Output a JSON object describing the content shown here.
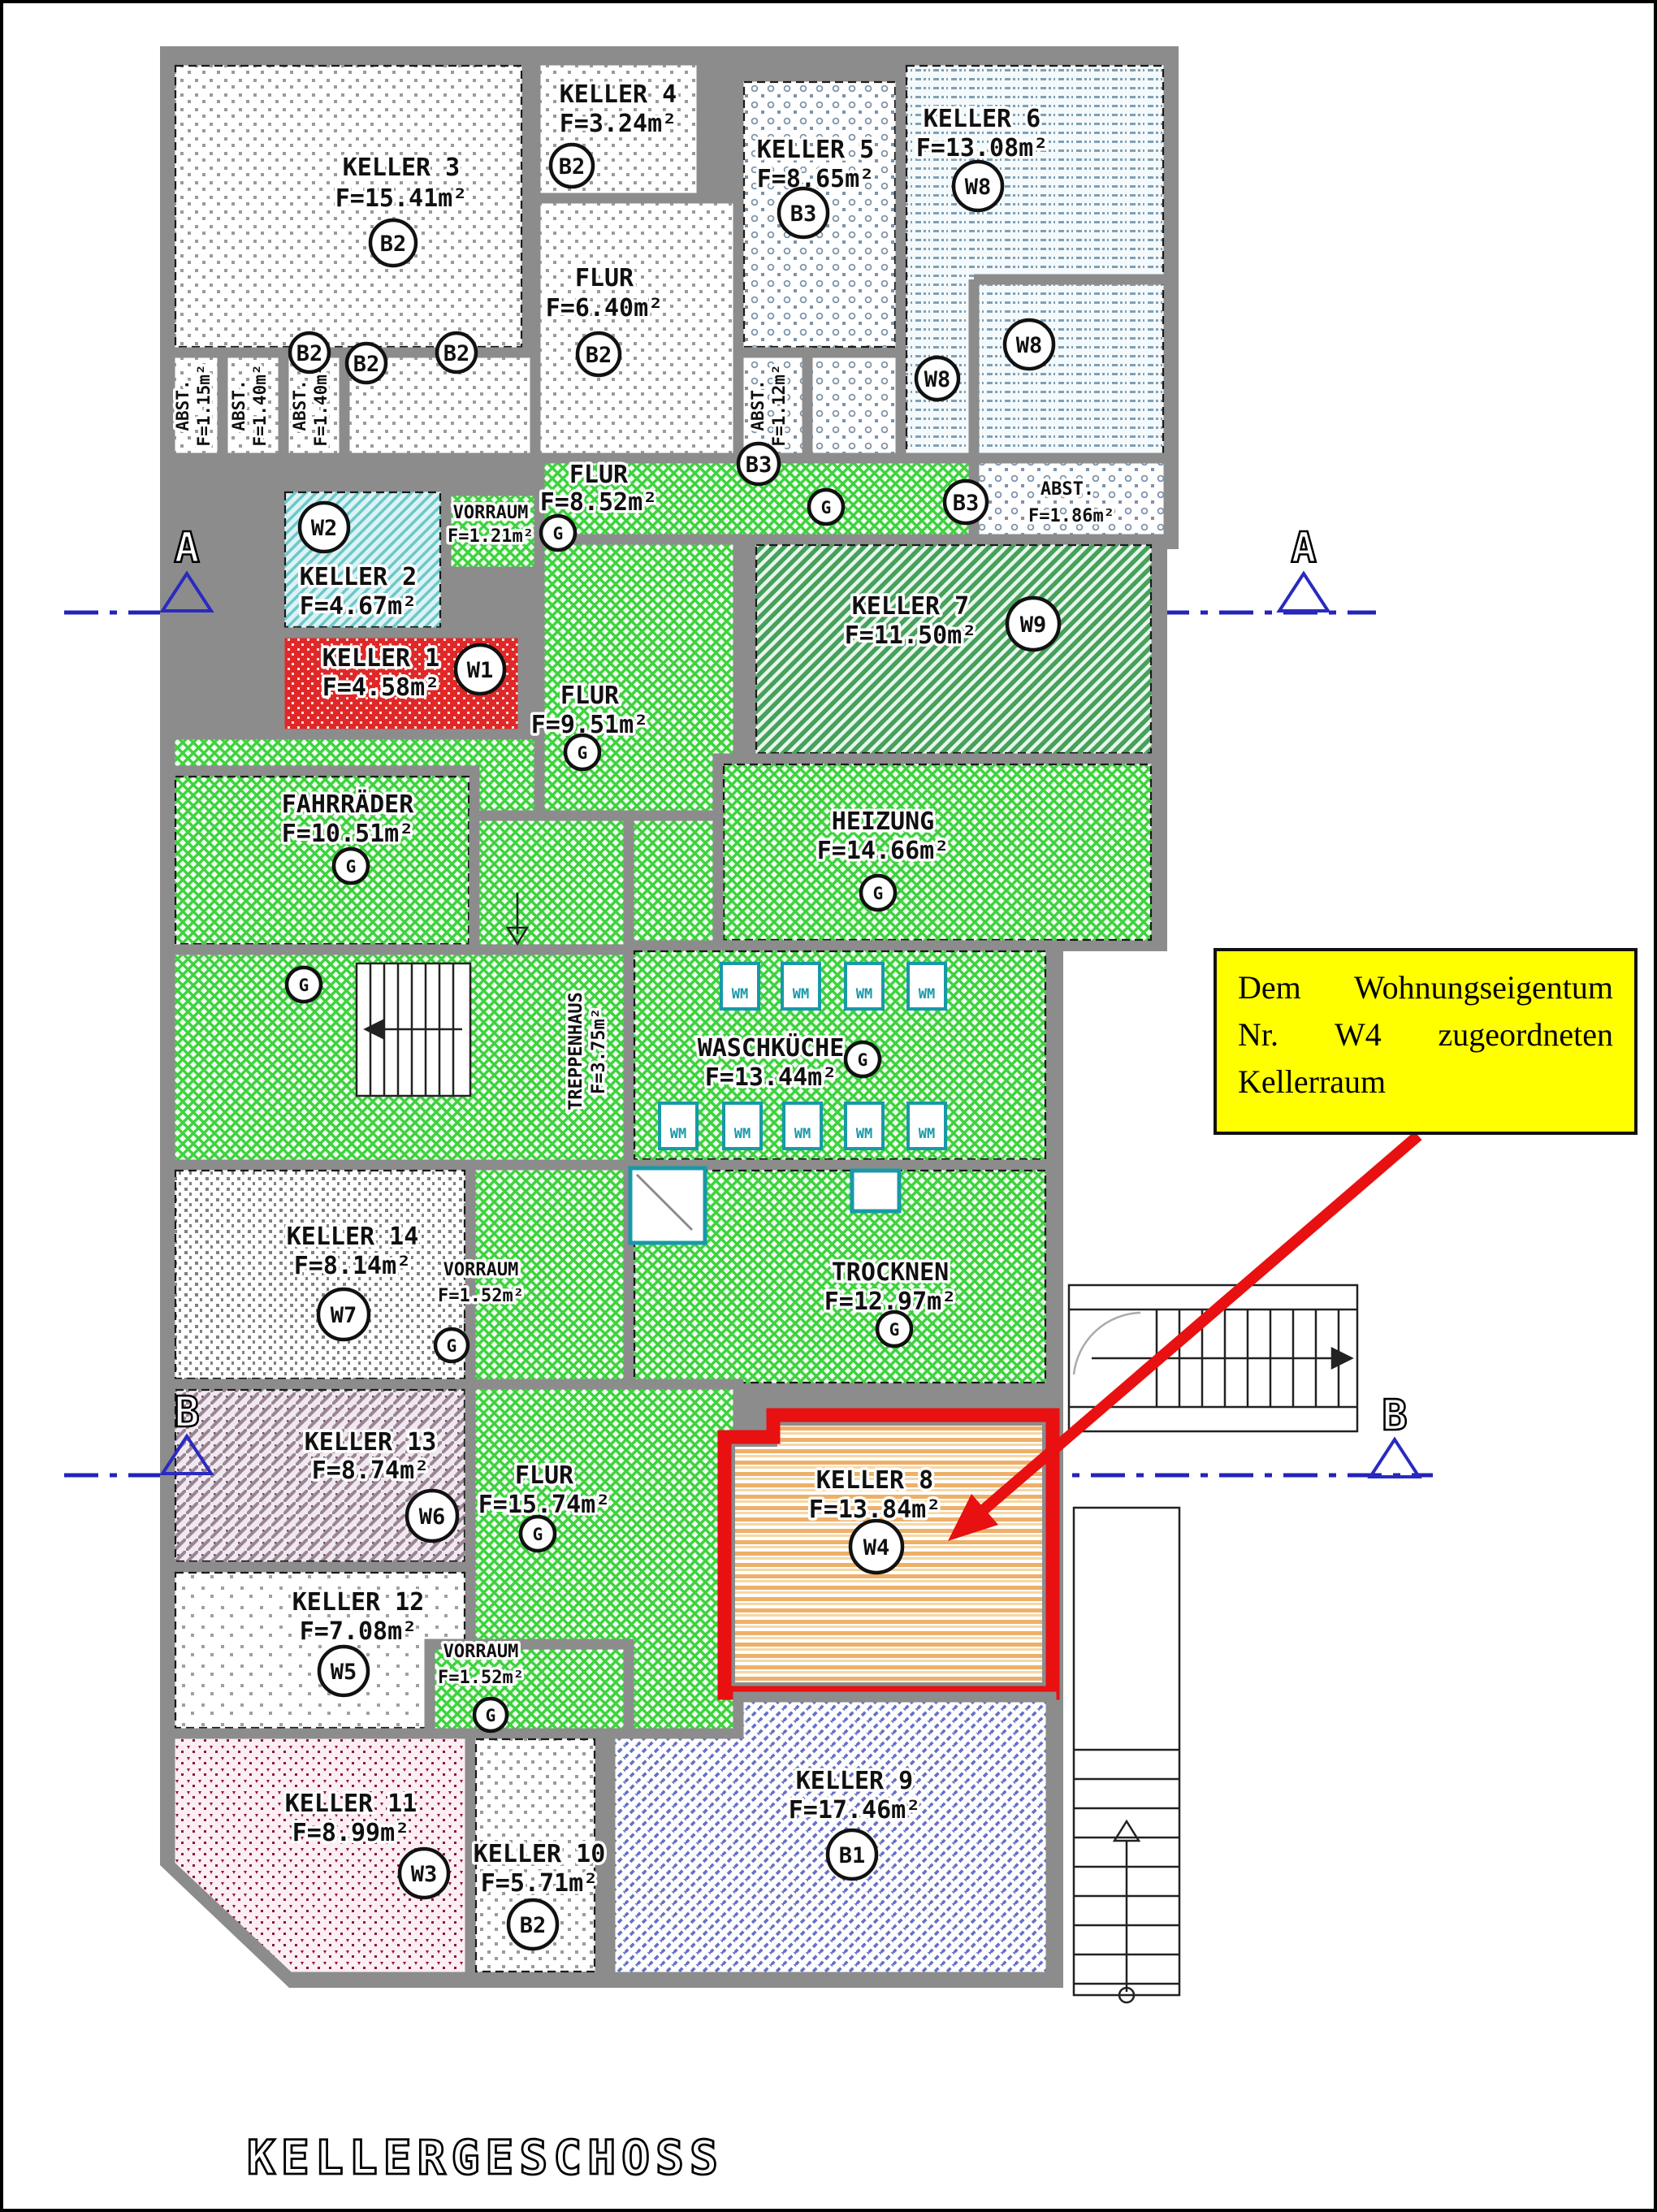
{
  "page": {
    "title": "KELLERGESCHOSS"
  },
  "annotation": {
    "lines": [
      "Dem Wohnungseigentum",
      "Nr. W4 zugeordneten",
      "Kellerraum"
    ]
  },
  "markers": {
    "a": "A",
    "b": "B"
  },
  "labels": {
    "wm": "WM"
  },
  "rooms": {
    "keller1": {
      "name": "KELLER 1",
      "area": "F=4.58m²",
      "badge": "W1"
    },
    "keller2": {
      "name": "KELLER 2",
      "area": "F=4.67m²",
      "badge": "W2"
    },
    "keller3": {
      "name": "KELLER 3",
      "area": "F=15.41m²",
      "badge": "B2"
    },
    "keller4": {
      "name": "KELLER 4",
      "area": "F=3.24m²",
      "badge": "B2"
    },
    "keller5": {
      "name": "KELLER 5",
      "area": "F=8.65m²",
      "badge": "B3"
    },
    "keller6": {
      "name": "KELLER 6",
      "area": "F=13.08m²",
      "badge": "W8"
    },
    "keller7": {
      "name": "KELLER 7",
      "area": "F=11.50m²",
      "badge": "W9"
    },
    "keller8": {
      "name": "KELLER 8",
      "area": "F=13.84m²",
      "badge": "W4"
    },
    "keller9": {
      "name": "KELLER 9",
      "area": "F=17.46m²",
      "badge": "B1"
    },
    "keller10": {
      "name": "KELLER 10",
      "area": "F=5.71m²",
      "badge": "B2"
    },
    "keller11": {
      "name": "KELLER 11",
      "area": "F=8.99m²",
      "badge": "W3"
    },
    "keller12": {
      "name": "KELLER 12",
      "area": "F=7.08m²",
      "badge": "W5"
    },
    "keller13": {
      "name": "KELLER 13",
      "area": "F=8.74m²",
      "badge": "W6"
    },
    "keller14": {
      "name": "KELLER 14",
      "area": "F=8.14m²",
      "badge": "W7"
    },
    "flur_top": {
      "name": "FLUR",
      "area": "F=6.40m²",
      "badge": "B2"
    },
    "flur_852": {
      "name": "FLUR",
      "area": "F=8.52m²",
      "badge": "G"
    },
    "flur_951": {
      "name": "FLUR",
      "area": "F=9.51m²",
      "badge": "G"
    },
    "flur_1574": {
      "name": "FLUR",
      "area": "F=15.74m²",
      "badge": "G"
    },
    "vorraum_121": {
      "name": "VORRAUM",
      "area": "F=1.21m²",
      "badge": "G"
    },
    "vorraum_152a": {
      "name": "VORRAUM",
      "area": "F=1.52m²",
      "badge": "G"
    },
    "vorraum_152b": {
      "name": "VORRAUM",
      "area": "F=1.52m²",
      "badge": "G"
    },
    "fahrraeder": {
      "name": "FAHRRÄDER",
      "area": "F=10.51m²",
      "badge": "G"
    },
    "heizung": {
      "name": "HEIZUNG",
      "area": "F=14.66m²",
      "badge": "G"
    },
    "waschkueche": {
      "name": "WASCHKÜCHE",
      "area": "F=13.44m²",
      "badge": "G"
    },
    "trocknen": {
      "name": "TROCKNEN",
      "area": "F=12.97m²",
      "badge": "G"
    },
    "treppenhaus": {
      "name": "TREPPENHAUS",
      "area": "F=3.75m²",
      "badge": "G"
    },
    "abst_115": {
      "name": "ABST.",
      "area": "F=1.15m²",
      "badge": "B2"
    },
    "abst_140a": {
      "name": "ABST.",
      "area": "F=1.40m²",
      "badge": "B2"
    },
    "abst_140b": {
      "name": "ABST.",
      "area": "F=1.40m²",
      "badge": "B2"
    },
    "abst_112": {
      "name": "ABST.",
      "area": "F=1.12m²",
      "badge": "B3"
    },
    "abst_186": {
      "name": "ABST.",
      "area": "F=1.86m²",
      "badge": "B3"
    }
  }
}
